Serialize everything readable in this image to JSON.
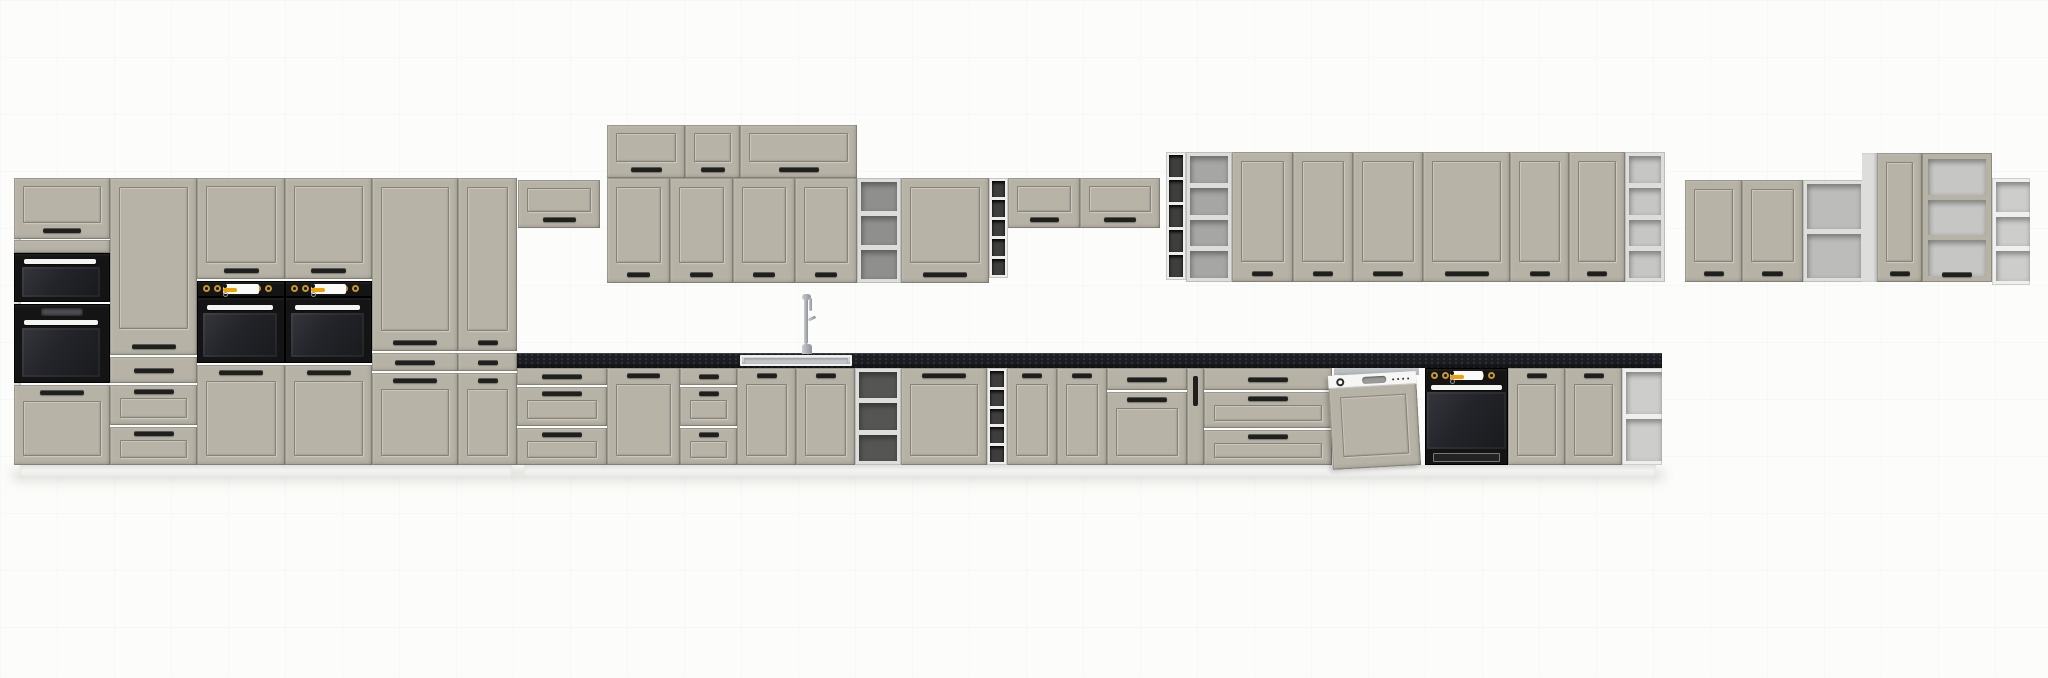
{
  "meta": {
    "description": "3D product render of a modular kitchen furniture set, elevation view on a white studio background",
    "door_style": "shaker frame fronts",
    "appliances": [
      "microwave",
      "tall built-in oven",
      "two tower ovens",
      "dishwasher",
      "under-counter oven",
      "sink with faucet"
    ]
  },
  "canvas": {
    "w": 2048,
    "h": 678
  },
  "palette": {
    "front": "#b6b2a6",
    "carc": "#dddddb",
    "gold": "#c69733",
    "orange": "#f0a000",
    "counter": "#1d1e23",
    "handle": "#1f1f1d",
    "plinth": "#f3f3f1",
    "background": "#fcfcfa"
  },
  "modules": [
    {
      "name": "ground-shadow",
      "type": "shadow",
      "x": 12,
      "y": 470,
      "w": 1652,
      "h": 10
    },
    {
      "name": "plinth-tall-run",
      "type": "plinth",
      "x": 20,
      "y": 465,
      "w": 492,
      "h": 13
    },
    {
      "name": "plinth-base-run",
      "type": "plinth",
      "x": 524,
      "y": 465,
      "w": 1132,
      "h": 13
    },
    {
      "name": "tall1-side-panel",
      "type": "side",
      "x": 14,
      "y": 178,
      "w": 7,
      "h": 287
    },
    {
      "name": "tall1-top-flip-door",
      "type": "flip",
      "x": 14,
      "y": 178,
      "w": 96,
      "h": 61
    },
    {
      "name": "tall1-filler-panel",
      "type": "blank",
      "x": 14,
      "y": 240,
      "w": 96,
      "h": 13
    },
    {
      "name": "microwave",
      "type": "micro",
      "x": 14,
      "y": 253,
      "w": 96,
      "h": 49
    },
    {
      "name": "tall-built-in-oven",
      "type": "oven-tall",
      "x": 14,
      "y": 304,
      "w": 96,
      "h": 79,
      "opts": {
        "display": true
      }
    },
    {
      "name": "tall1-bottom-door",
      "type": "door",
      "x": 14,
      "y": 385,
      "w": 96,
      "h": 80,
      "opts": {
        "handle": "top"
      }
    },
    {
      "name": "tall2-door",
      "type": "door",
      "x": 110,
      "y": 178,
      "w": 87,
      "h": 177,
      "opts": {
        "handle": "bottom",
        "panelBottom": 26
      }
    },
    {
      "name": "tall2-drawer-1",
      "type": "drawer",
      "x": 110,
      "y": 357,
      "w": 87,
      "h": 26,
      "opts": {
        "style": "plain"
      }
    },
    {
      "name": "tall2-drawer-2",
      "type": "drawer",
      "x": 110,
      "y": 385,
      "w": 87,
      "h": 40,
      "opts": {
        "style": "framed"
      }
    },
    {
      "name": "tall2-drawer-3",
      "type": "drawer",
      "x": 110,
      "y": 427,
      "w": 87,
      "h": 38,
      "opts": {
        "style": "framed"
      }
    },
    {
      "name": "oven-tower1-flip-door",
      "type": "flip",
      "x": 197,
      "y": 178,
      "w": 88,
      "h": 101
    },
    {
      "name": "oven-tower1-control-panel",
      "type": "ctrl",
      "x": 197,
      "y": 281,
      "w": 88,
      "h": 16
    },
    {
      "name": "oven-tower1-oven",
      "type": "oven-tall",
      "x": 197,
      "y": 297,
      "w": 88,
      "h": 66
    },
    {
      "name": "oven-tower1-door",
      "type": "door",
      "x": 197,
      "y": 365,
      "w": 88,
      "h": 100,
      "opts": {
        "handle": "top"
      }
    },
    {
      "name": "oven-tower2-flip-door",
      "type": "flip",
      "x": 285,
      "y": 178,
      "w": 87,
      "h": 101
    },
    {
      "name": "oven-tower2-control-panel",
      "type": "ctrl",
      "x": 285,
      "y": 281,
      "w": 87,
      "h": 16
    },
    {
      "name": "oven-tower2-oven",
      "type": "oven-tall",
      "x": 285,
      "y": 297,
      "w": 87,
      "h": 66
    },
    {
      "name": "oven-tower2-door",
      "type": "door",
      "x": 285,
      "y": 365,
      "w": 87,
      "h": 100,
      "opts": {
        "handle": "top"
      }
    },
    {
      "name": "larder1-door",
      "type": "door",
      "x": 372,
      "y": 178,
      "w": 86,
      "h": 173,
      "opts": {
        "handle": "bottom"
      }
    },
    {
      "name": "larder1-drawer",
      "type": "drawer",
      "x": 372,
      "y": 353,
      "w": 86,
      "h": 18,
      "opts": {
        "style": "plain"
      }
    },
    {
      "name": "larder1-bottom-door",
      "type": "door",
      "x": 372,
      "y": 373,
      "w": 86,
      "h": 92,
      "opts": {
        "handle": "top"
      }
    },
    {
      "name": "larder2-door",
      "type": "door",
      "x": 458,
      "y": 178,
      "w": 59,
      "h": 173,
      "opts": {
        "handle": "bottom"
      }
    },
    {
      "name": "larder2-drawer",
      "type": "drawer",
      "x": 458,
      "y": 353,
      "w": 59,
      "h": 18,
      "opts": {
        "style": "plain"
      }
    },
    {
      "name": "larder2-bottom-door",
      "type": "door",
      "x": 458,
      "y": 373,
      "w": 59,
      "h": 92,
      "opts": {
        "handle": "top"
      }
    },
    {
      "name": "wall-flip-over-counter",
      "type": "flip",
      "x": 518,
      "y": 180,
      "w": 82,
      "h": 48
    },
    {
      "name": "wall-top-flip-1",
      "type": "flip",
      "x": 607,
      "y": 125,
      "w": 78,
      "h": 53
    },
    {
      "name": "wall-top-flip-2",
      "type": "flip",
      "x": 685,
      "y": 125,
      "w": 55,
      "h": 53
    },
    {
      "name": "wall-top-flip-wide",
      "type": "flip",
      "x": 740,
      "y": 125,
      "w": 117,
      "h": 53
    },
    {
      "name": "wall-door-1",
      "type": "door",
      "x": 607,
      "y": 178,
      "w": 63,
      "h": 105,
      "opts": {
        "handle": "bottom"
      }
    },
    {
      "name": "wall-door-2",
      "type": "door",
      "x": 670,
      "y": 178,
      "w": 63,
      "h": 105,
      "opts": {
        "handle": "bottom"
      }
    },
    {
      "name": "wall-door-3",
      "type": "door",
      "x": 733,
      "y": 178,
      "w": 62,
      "h": 105,
      "opts": {
        "handle": "bottom"
      }
    },
    {
      "name": "wall-door-4",
      "type": "door",
      "x": 795,
      "y": 178,
      "w": 62,
      "h": 105,
      "opts": {
        "handle": "bottom"
      }
    },
    {
      "name": "wall-open-shelf-1",
      "type": "open",
      "x": 857,
      "y": 178,
      "w": 44,
      "h": 105,
      "opts": {
        "comps": 3,
        "interior": "#8f8f8d"
      }
    },
    {
      "name": "wall-door-5",
      "type": "door",
      "x": 901,
      "y": 178,
      "w": 88,
      "h": 105,
      "opts": {
        "handle": "bottom"
      }
    },
    {
      "name": "wall-wine-rack-1",
      "type": "wine",
      "x": 989,
      "y": 178,
      "w": 19,
      "h": 100
    },
    {
      "name": "wall-flip-3",
      "type": "flip",
      "x": 1008,
      "y": 178,
      "w": 72,
      "h": 50
    },
    {
      "name": "wall-flip-4",
      "type": "flip",
      "x": 1080,
      "y": 178,
      "w": 80,
      "h": 50
    },
    {
      "name": "wall-wine-rack-2",
      "type": "wine",
      "x": 1166,
      "y": 152,
      "w": 20,
      "h": 128
    },
    {
      "name": "wall-open-shelf-2",
      "type": "open",
      "x": 1186,
      "y": 152,
      "w": 46,
      "h": 130,
      "opts": {
        "comps": 4,
        "interior": "#a6a6a4"
      }
    },
    {
      "name": "wall-door-6",
      "type": "door",
      "x": 1232,
      "y": 152,
      "w": 61,
      "h": 130,
      "opts": {
        "handle": "bottom"
      }
    },
    {
      "name": "wall-door-7",
      "type": "door",
      "x": 1293,
      "y": 152,
      "w": 60,
      "h": 130,
      "opts": {
        "handle": "bottom"
      }
    },
    {
      "name": "wall-door-8",
      "type": "door",
      "x": 1353,
      "y": 152,
      "w": 70,
      "h": 130,
      "opts": {
        "handle": "bottom"
      }
    },
    {
      "name": "wall-door-9",
      "type": "door",
      "x": 1423,
      "y": 152,
      "w": 87,
      "h": 130,
      "opts": {
        "handle": "bottom"
      }
    },
    {
      "name": "wall-door-10",
      "type": "door",
      "x": 1510,
      "y": 152,
      "w": 59,
      "h": 130,
      "opts": {
        "handle": "bottom"
      }
    },
    {
      "name": "wall-door-11",
      "type": "door",
      "x": 1569,
      "y": 152,
      "w": 56,
      "h": 130,
      "opts": {
        "handle": "bottom"
      }
    },
    {
      "name": "wall-open-shelf-3",
      "type": "open",
      "x": 1625,
      "y": 152,
      "w": 40,
      "h": 130,
      "opts": {
        "comps": 4,
        "interior": "#c6c6c4"
      }
    },
    {
      "name": "right-wall-door-1",
      "type": "door",
      "x": 1685,
      "y": 180,
      "w": 57,
      "h": 102,
      "opts": {
        "handle": "bottom"
      }
    },
    {
      "name": "right-wall-door-2",
      "type": "door",
      "x": 1742,
      "y": 180,
      "w": 61,
      "h": 102,
      "opts": {
        "handle": "bottom"
      }
    },
    {
      "name": "right-wall-open-shelf",
      "type": "open",
      "x": 1803,
      "y": 180,
      "w": 62,
      "h": 102,
      "opts": {
        "comps": 2,
        "interior": "#bcbcba"
      }
    },
    {
      "name": "right-wall-side-panel",
      "type": "side",
      "x": 1862,
      "y": 153,
      "w": 15,
      "h": 129
    },
    {
      "name": "right-wall-door-3",
      "type": "door",
      "x": 1877,
      "y": 153,
      "w": 45,
      "h": 129,
      "opts": {
        "handle": "bottom"
      }
    },
    {
      "name": "right-wall-vitrine",
      "type": "open",
      "x": 1922,
      "y": 153,
      "w": 70,
      "h": 129,
      "opts": {
        "comps": 3,
        "interior": "#c6c6c4",
        "frame": true
      }
    },
    {
      "name": "right-wall-corner-shelf",
      "type": "corner",
      "x": 1992,
      "y": 178,
      "w": 38,
      "h": 107,
      "opts": {
        "comps": 3
      }
    },
    {
      "name": "base-drawers-1",
      "type": "drawers",
      "x": 517,
      "y": 368,
      "w": 90,
      "h": 97
    },
    {
      "name": "base-door-1",
      "type": "door",
      "x": 607,
      "y": 368,
      "w": 73,
      "h": 97,
      "opts": {
        "handle": "top"
      }
    },
    {
      "name": "base-drawers-2",
      "type": "drawers",
      "x": 680,
      "y": 368,
      "w": 57,
      "h": 97
    },
    {
      "name": "sink-base-door-1",
      "type": "door",
      "x": 737,
      "y": 368,
      "w": 59,
      "h": 97,
      "opts": {
        "handle": "top"
      }
    },
    {
      "name": "sink-base-door-2",
      "type": "door",
      "x": 796,
      "y": 368,
      "w": 59,
      "h": 97,
      "opts": {
        "handle": "top"
      }
    },
    {
      "name": "base-open-shelf",
      "type": "open",
      "x": 855,
      "y": 368,
      "w": 46,
      "h": 97,
      "opts": {
        "comps": 3,
        "interior": "#555553"
      }
    },
    {
      "name": "base-door-2",
      "type": "door",
      "x": 901,
      "y": 368,
      "w": 86,
      "h": 97,
      "opts": {
        "handle": "top"
      }
    },
    {
      "name": "base-wine-rack",
      "type": "wine",
      "x": 987,
      "y": 368,
      "w": 20,
      "h": 97
    },
    {
      "name": "base-door-3",
      "type": "door",
      "x": 1007,
      "y": 368,
      "w": 50,
      "h": 97,
      "opts": {
        "handle": "top"
      }
    },
    {
      "name": "base-door-4",
      "type": "door",
      "x": 1057,
      "y": 368,
      "w": 50,
      "h": 97,
      "opts": {
        "handle": "top"
      }
    },
    {
      "name": "base-top-drawer",
      "type": "drawer",
      "x": 1107,
      "y": 368,
      "w": 80,
      "h": 22,
      "opts": {
        "style": "plain"
      }
    },
    {
      "name": "base-door-under-drawer",
      "type": "door",
      "x": 1107,
      "y": 392,
      "w": 80,
      "h": 73,
      "opts": {
        "handle": "top"
      }
    },
    {
      "name": "base-pullout",
      "type": "pullout",
      "x": 1187,
      "y": 368,
      "w": 17,
      "h": 97
    },
    {
      "name": "base-drawers-3",
      "type": "drawers",
      "x": 1204,
      "y": 368,
      "w": 128,
      "h": 97,
      "opts": {
        "rows": [
          22,
          36,
          35
        ]
      }
    },
    {
      "name": "dishwasher",
      "type": "dishwasher",
      "x": 1332,
      "y": 362,
      "w": 93,
      "h": 103
    },
    {
      "name": "built-in-oven",
      "type": "oven-base",
      "x": 1425,
      "y": 368,
      "w": 83,
      "h": 97
    },
    {
      "name": "base-door-5",
      "type": "door",
      "x": 1508,
      "y": 368,
      "w": 57,
      "h": 97,
      "opts": {
        "handle": "top"
      }
    },
    {
      "name": "base-door-6",
      "type": "door",
      "x": 1565,
      "y": 368,
      "w": 57,
      "h": 97,
      "opts": {
        "handle": "top"
      }
    },
    {
      "name": "base-corner-shelf",
      "type": "corner",
      "x": 1622,
      "y": 368,
      "w": 40,
      "h": 97,
      "opts": {
        "comps": 2
      }
    },
    {
      "name": "countertop",
      "type": "counter",
      "x": 517,
      "y": 353,
      "w": 1145,
      "h": 15
    },
    {
      "name": "sink",
      "type": "sink",
      "x": 740,
      "y": 355,
      "w": 112,
      "h": 11
    },
    {
      "name": "faucet",
      "type": "faucet",
      "x": 795,
      "y": 292,
      "w": 24,
      "h": 62
    }
  ]
}
